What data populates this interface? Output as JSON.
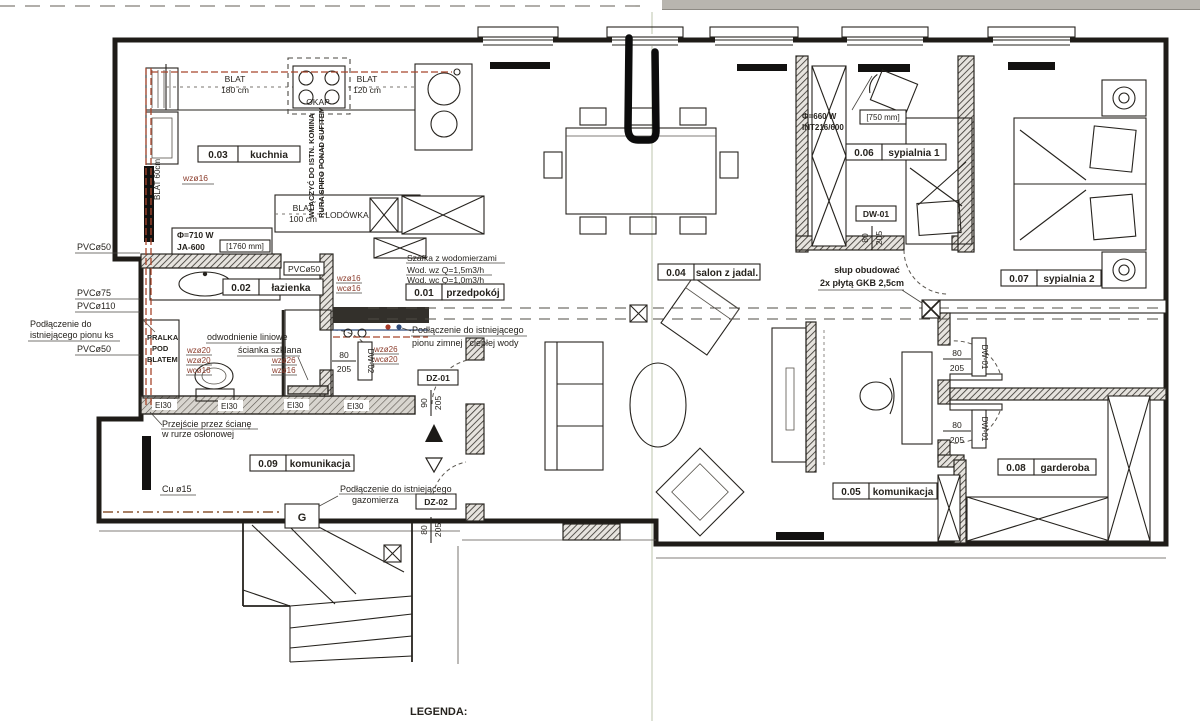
{
  "legend": {
    "title": "LEGENDA:"
  },
  "rooms": {
    "r01": {
      "number": "0.01",
      "name": "przedpokój"
    },
    "r02": {
      "number": "0.02",
      "name": "łazienka"
    },
    "r03": {
      "number": "0.03",
      "name": "kuchnia"
    },
    "r04": {
      "number": "0.04",
      "name": "salon z jadal."
    },
    "r05": {
      "number": "0.05",
      "name": "komunikacja"
    },
    "r06": {
      "number": "0.06",
      "name": "sypialnia 1"
    },
    "r07": {
      "number": "0.07",
      "name": "sypialnia 2"
    },
    "r08": {
      "number": "0.08",
      "name": "garderoba"
    },
    "r09": {
      "number": "0.09",
      "name": "komunikacja"
    }
  },
  "kitchen": {
    "blat180_line1": "BLAT",
    "blat180_line2": "180 cm",
    "okap": "OKAP",
    "blat120_line1": "BLAT",
    "blat120_line2": "120 cm",
    "blat100_line1": "BLAT",
    "blat100_line2": "100 cm",
    "lodowka": "LODÓWKA",
    "blat60": "BLAT 60cm",
    "wz16": "wzø16",
    "chimney_line1": "WŁĄCZYĆ DO ISTN. KOMINA",
    "chimney_line2": "RURA SPIRO PONAD SUFITEM",
    "radiator_power": "Φ=710 W",
    "radiator_model": "JA-600",
    "radiator_width": "[1760 mm]"
  },
  "bathroom": {
    "pvc50": "PVCø50",
    "pralka_line1": "PRALKA",
    "pralka_line2": "POD",
    "pralka_line3": "BLATEM",
    "drain_note": "odwodnienie liniowe",
    "glass_note": "ścianka szklana",
    "wz20_a": "wzø20",
    "wz20_b": "wzø20",
    "wc16": "wcø16",
    "wz26": "wzø26",
    "wz16": "wzø16",
    "fire_rating": "EI30",
    "pass_line1": "Przejście przez ścianę",
    "pass_line2": "w rurze osłonowej",
    "door_code": "DW-02",
    "door_width": "80",
    "door_height": "205"
  },
  "hall": {
    "meter_title": "Szafka z wodomierzami",
    "meter_line1": "Wod. wz Q=1,5m3/h",
    "meter_line2": "Wod. wc Q=1,0m3/h",
    "wz16": "wzø16",
    "wc16": "wcø16",
    "wz26": "wzø26",
    "wc20": "wcø20",
    "water_line1": "Podłączenie do istniejącego",
    "water_line2": "pionu zimnej i ciepłej wody",
    "dz01_code": "DZ-01",
    "dz01_width": "90",
    "dz01_height": "205",
    "dz02_code": "DZ-02",
    "dz02_width": "80",
    "dz02_height": "205"
  },
  "risers": {
    "pvc50_top": "PVCø50",
    "pvc75": "PVCø75",
    "pvc110": "PVCø110",
    "ks_line1": "Podłączenie do",
    "ks_line2": "istniejącego pionu ks",
    "pvc50_bottom": "PVCø50"
  },
  "gas": {
    "pipe": "Cu ø15",
    "note_line1": "Podłączenie do istniejącego",
    "note_line2": "gazomierza",
    "meter": "G"
  },
  "salon": {
    "column_line1": "słup obudować",
    "column_line2": "2x płytą GKB 2,5cm"
  },
  "bedroom1": {
    "radiator_power": "Φ=660 W",
    "radiator_model": "INT216/600",
    "radiator_width": "[750 mm]",
    "door_code": "DW-01",
    "door_width": "80",
    "door_height": "205"
  },
  "wardrobe": {
    "door1_code": "DW-01",
    "door1_width": "80",
    "door1_height": "205",
    "door2_code": "DW-01",
    "door2_width": "80",
    "door2_height": "205"
  }
}
